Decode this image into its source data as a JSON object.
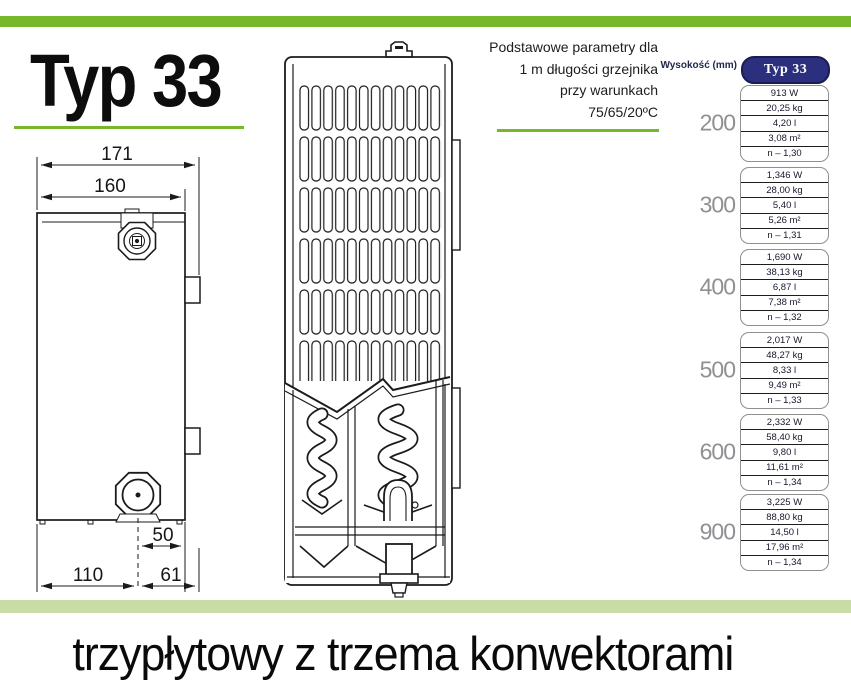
{
  "header": {
    "title": "Typ 33",
    "note_lines": [
      "Podstawowe parametry dla",
      "1 m długości grzejnika",
      "przy warunkach",
      "75/65/20ºC"
    ]
  },
  "diagram": {
    "dimensions": {
      "top_width": "171",
      "panel_width": "160",
      "valve_offset": "50",
      "bottom_left": "110",
      "bottom_right": "61"
    }
  },
  "table": {
    "row_header_label": "Wysokość (mm)",
    "column_header": "Typ 33",
    "groups": [
      {
        "height": "200",
        "rows": [
          "913 W",
          "20,25 kg",
          "4,20 l",
          "3,08 m²",
          "n – 1,30"
        ]
      },
      {
        "height": "300",
        "rows": [
          "1,346 W",
          "28,00 kg",
          "5,40 l",
          "5,26 m²",
          "n – 1,31"
        ]
      },
      {
        "height": "400",
        "rows": [
          "1,690 W",
          "38,13 kg",
          "6,87 l",
          "7,38 m²",
          "n – 1,32"
        ]
      },
      {
        "height": "500",
        "rows": [
          "2,017 W",
          "48,27 kg",
          "8,33 l",
          "9,49 m²",
          "n – 1,33"
        ]
      },
      {
        "height": "600",
        "rows": [
          "2,332 W",
          "58,40 kg",
          "9,80 l",
          "11,61 m²",
          "n – 1,34"
        ]
      },
      {
        "height": "900",
        "rows": [
          "3,225 W",
          "88,80 kg",
          "14,50 l",
          "17,96 m²",
          "n – 1,34"
        ]
      }
    ]
  },
  "footer": {
    "caption": "trzypłytowy z trzema konwektorami"
  },
  "colors": {
    "accent_green": "#76b82a",
    "pale_green": "#c9dca6",
    "navy": "#2b2f7d"
  }
}
